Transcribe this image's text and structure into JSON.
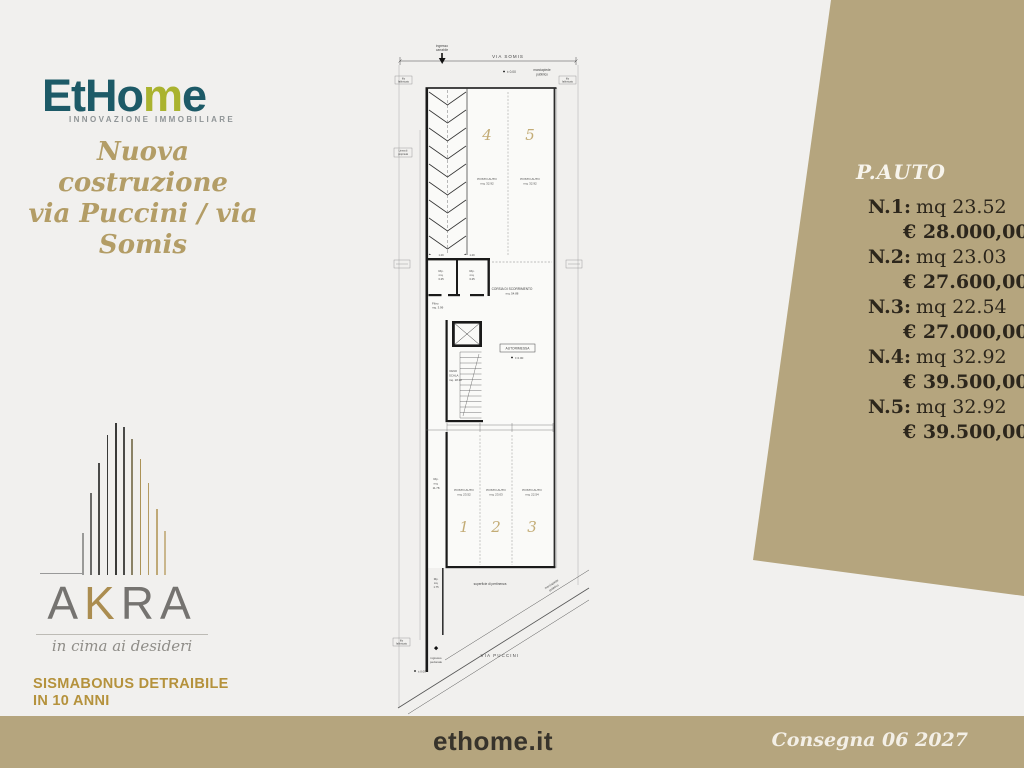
{
  "brand": {
    "logo_part1": "EtHo",
    "logo_part2": "m",
    "logo_part3": "e",
    "tagline": "INNOVAZIONE IMMOBILIARE",
    "teal": "#1d5a67",
    "green": "#aab32f"
  },
  "headline": {
    "line1": "Nuova costruzione",
    "line2": "via Puccini / via Somis"
  },
  "akra": {
    "part1": "A",
    "part2": "K",
    "part3": "RA",
    "tagline": "in cima ai desideri"
  },
  "promo": {
    "line1": "SISMABONUS DETRAIBILE",
    "line2": "IN 10 ANNI"
  },
  "price_panel": {
    "title": "P.AUTO",
    "accent": "#b5a57e",
    "items": [
      {
        "label": "N.1:",
        "size": "mq 23.52",
        "price": "€ 28.000,00"
      },
      {
        "label": "N.2:",
        "size": "mq 23.03",
        "price": "€ 27.600,00"
      },
      {
        "label": "N.3:",
        "size": "mq 22.54",
        "price": "€ 27.000,00"
      },
      {
        "label": "N.4:",
        "size": "mq 32.92",
        "price": "€ 39.500,00"
      },
      {
        "label": "N.5:",
        "size": "mq 32.92",
        "price": "€ 39.500,00"
      }
    ]
  },
  "footer": {
    "site": "ethome.it",
    "delivery": "Consegna 06 2027"
  },
  "plan": {
    "street_top": "VIA SOMIS",
    "street_bottom": "VIA PUCCINI",
    "ingresso_carr_1": "ingresso",
    "ingresso_carr_2": "carrabile",
    "marciapiede_1": "marciapiede",
    "marciapiede_2": "pubblico",
    "filo_1": "filo",
    "filo_2": "fabbricato",
    "linea_1": "Linea di",
    "linea_2": "proprietà",
    "quota_zero": "± 0.00",
    "posto_auto": "POSTO AUTO",
    "size4": "mq. 32.92",
    "size5": "mq. 32.92",
    "size1": "mq. 23.52",
    "size2": "mq. 23.03",
    "size3": "mq. 22.54",
    "n1": "1",
    "n2": "2",
    "n3": "3",
    "n4": "4",
    "n5": "5",
    "corsia_1": "CORSIA DI SCORRIMENTO",
    "corsia_2": "mq. 54.88",
    "rip_1": "Rip.",
    "rip_2": "mq.",
    "rip_3": "3.25",
    "dim_129": "1.29",
    "filtro_1": "Filtro",
    "filtro_2": "mq. 3.99",
    "vano_1": "VANO",
    "vano_2": "SCALA",
    "vano_3": "mq. 18.32",
    "autorimessa": "AUTORIMESSA",
    "ripbig_1": "Rip.",
    "ripbig_2": "mq.",
    "ripbig_3": "11.78",
    "ripsmall_1": "Rip.",
    "ripsmall_2": "mq.",
    "ripsmall_3": "1.75",
    "superficie": "superficie di pertinenza",
    "ingresso_ped_1": "ingresso",
    "ingresso_ped_2": "pedonale"
  }
}
